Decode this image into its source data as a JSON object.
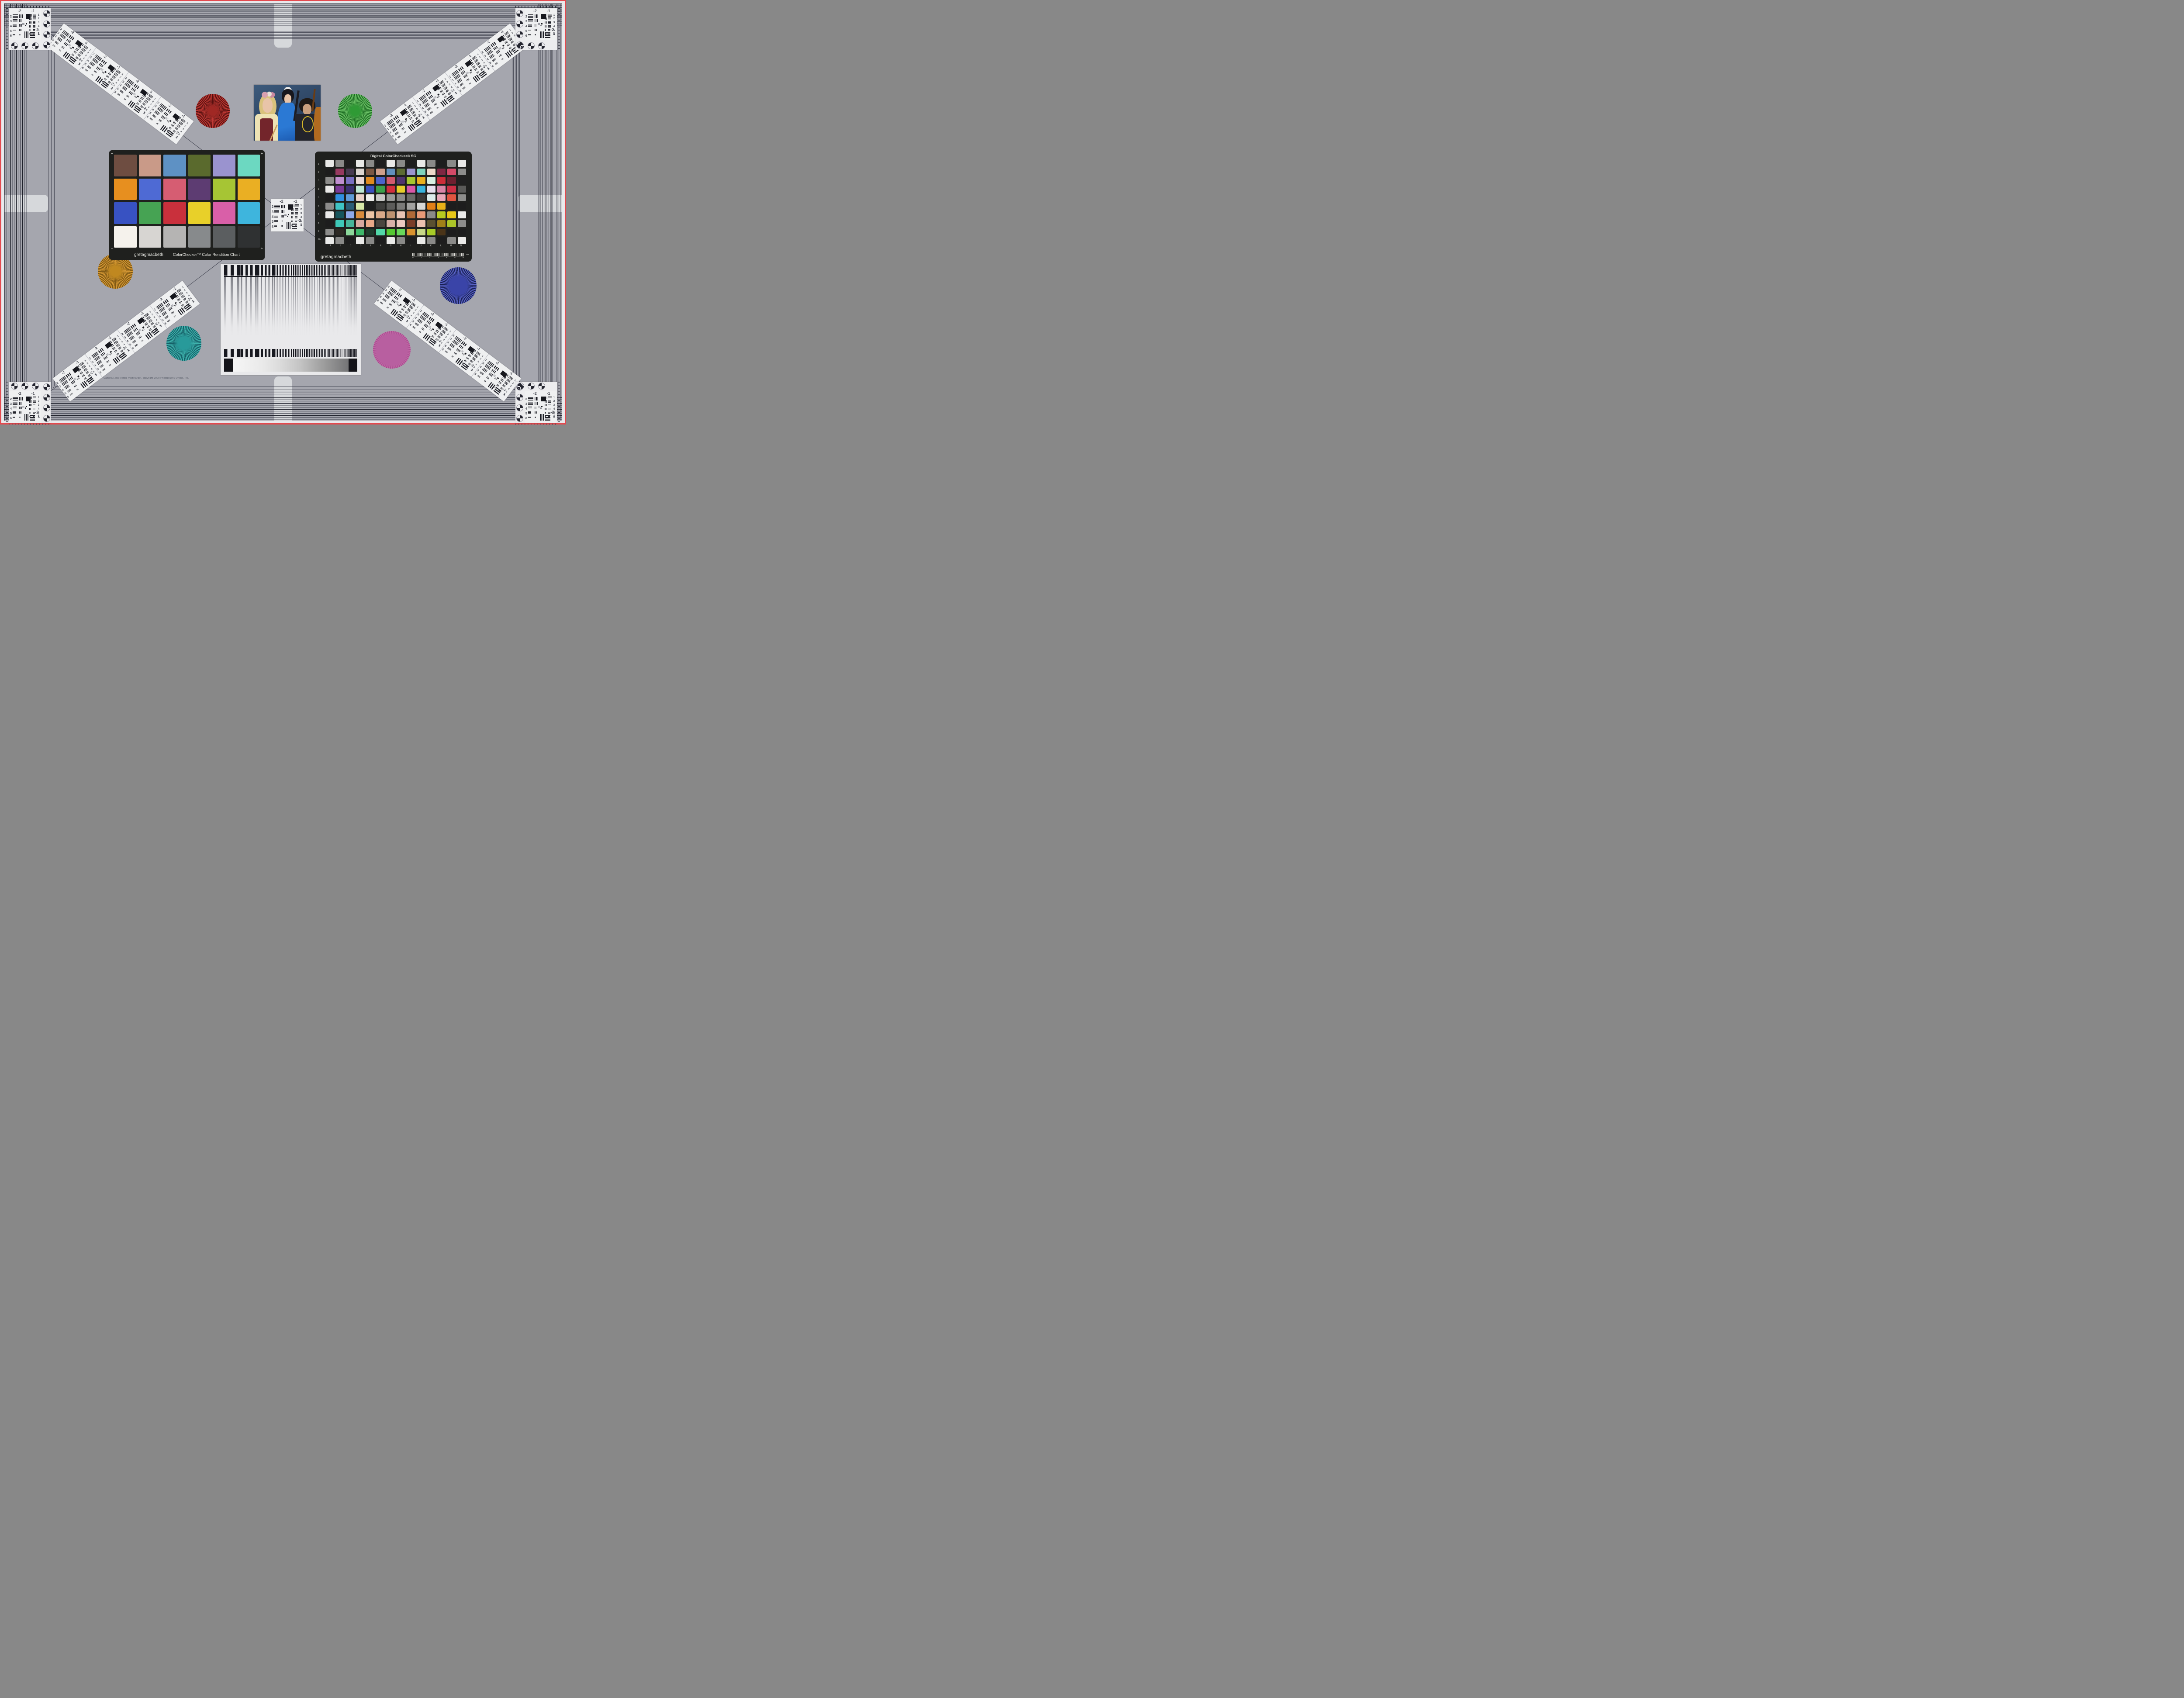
{
  "background": {
    "field_gray": "#a5a6ae",
    "edge_red": "#e4494e",
    "edge_white": "#e9e9ec",
    "line_dark": "#23242e"
  },
  "usaf_target": {
    "top_labels": [
      "-2",
      "-1"
    ],
    "left_numbers": [
      "2",
      "3",
      "4",
      "5",
      "6"
    ],
    "right_numbers": [
      "1",
      "2",
      "3",
      "4",
      "5",
      "6"
    ],
    "bottom_labels": [
      "-2",
      "1"
    ]
  },
  "colorchecker": {
    "brand": "gretagmacbeth",
    "title": "ColorChecker™ Color Rendition Chart",
    "patches": [
      "#6e4d41",
      "#c99a88",
      "#5e91c4",
      "#5a6a2d",
      "#9a93cf",
      "#6cd8c1",
      "#e78f1f",
      "#4e6ad4",
      "#d65d72",
      "#5d3c72",
      "#a6c534",
      "#eaaf23",
      "#3852c2",
      "#46a353",
      "#c9303c",
      "#e8d029",
      "#d95fa8",
      "#3eb5dd",
      "#f5f2ec",
      "#d7d5d2",
      "#b5b4b3",
      "#878a8c",
      "#5b5e60",
      "#2f3132"
    ]
  },
  "colorchecker_sg": {
    "title": "Digital ColorChecker® SG",
    "brand": "gretagmacbeth",
    "row_labels": [
      "1",
      "2",
      "3",
      "4",
      "5",
      "6",
      "7",
      "8",
      "9",
      "10"
    ],
    "column_labels": [
      "A",
      "B",
      "C",
      "D",
      "E",
      "F",
      "G",
      "H",
      "I",
      "J",
      "K",
      "L",
      "M",
      "N"
    ],
    "ruler_numbers": [
      "0",
      "1",
      "2",
      "3",
      "4",
      "5",
      "6"
    ],
    "ruler_unit": "mm",
    "patches": [
      [
        "#e9e9e7",
        "#8a8a88",
        "#1d1d1d",
        "#e9e9e7",
        "#8a8a88",
        "#1d1d1d",
        "#e9e9e7",
        "#8a8a88",
        "#1d1d1d",
        "#e9e9e7",
        "#8a8a88",
        "#1d1d1d",
        "#8a8a88",
        "#e9e9e7"
      ],
      [
        "#1d1d1d",
        "#973a60",
        "#473a50",
        "#dcd5d0",
        "#7a5743",
        "#cfa08c",
        "#6290bd",
        "#5d6b33",
        "#9a94ce",
        "#7fd3bd",
        "#ecd9c9",
        "#7e2742",
        "#d44a68",
        "#8d8d8b"
      ],
      [
        "#8c8c8a",
        "#c08fd0",
        "#7a6fc2",
        "#e9d7d5",
        "#e08a1f",
        "#4b64cc",
        "#d25a6e",
        "#50356e",
        "#a6c72f",
        "#e8b01f",
        "#d8f0e2",
        "#cc2d39",
        "#6e2030",
        "#202020"
      ],
      [
        "#e9e9e7",
        "#7a3a96",
        "#3a3172",
        "#bfe8d4",
        "#3a50c0",
        "#3ba04a",
        "#d22e3c",
        "#e6cd2a",
        "#d957a8",
        "#38b4dc",
        "#e7e0ee",
        "#d885a6",
        "#cc2f45",
        "#5a5a58"
      ],
      [
        "#1d1d1d",
        "#2f8fe0",
        "#5f9ad8",
        "#ead0c8",
        "#eeeeec",
        "#c7c7c5",
        "#9a9a98",
        "#8a8a88",
        "#6a6a68",
        "#3a3a38",
        "#dcecea",
        "#e8a8b8",
        "#e05540",
        "#8d8d8b"
      ],
      [
        "#8c8c8a",
        "#3fc4c4",
        "#2b5d76",
        "#d8e8a8",
        "#1e1e1e",
        "#3e3e3c",
        "#5c5c5a",
        "#7a7a78",
        "#a2a2a0",
        "#d8d8d6",
        "#e08018",
        "#e8b018",
        "#1d1d1d",
        "#1d1d1d"
      ],
      [
        "#eaeae8",
        "#17555c",
        "#8fa8e8",
        "#d88b3c",
        "#ecc4a4",
        "#d9a988",
        "#bd9270",
        "#e8c4b4",
        "#b06a38",
        "#e89a78",
        "#8a8a88",
        "#b8cc20",
        "#e8c818",
        "#eaeae8"
      ],
      [
        "#1d1d1d",
        "#3ec8b8",
        "#46b49a",
        "#d8a8a0",
        "#eaa888",
        "#4a443e",
        "#d8b0a8",
        "#ecc8c0",
        "#7a3c28",
        "#ecc0b0",
        "#5a5030",
        "#a08018",
        "#aac428",
        "#8d8d8b"
      ],
      [
        "#8c8c8a",
        "#2e2a24",
        "#8cd89a",
        "#3eb86a",
        "#1e3c2c",
        "#52d8a8",
        "#55c832",
        "#68d85a",
        "#d8922e",
        "#c8d888",
        "#a8cc28",
        "#4a3418",
        "#1d1d1d",
        "#1d1d1d"
      ],
      [
        "#eaeae8",
        "#8a8a88",
        "#1d1d1d",
        "#eaeae8",
        "#8a8a88",
        "#1d1d1d",
        "#eaeae8",
        "#8a8a88",
        "#1d1d1d",
        "#eaeae8",
        "#8a8a88",
        "#1d1d1d",
        "#8a8a88",
        "#eaeae8"
      ]
    ]
  },
  "siemens_stars": [
    {
      "name": "red-star",
      "light": "#c23a35",
      "dark": "#56100f",
      "core": "#a02824"
    },
    {
      "name": "green-star",
      "light": "#6ec468",
      "dark": "#1c6b22",
      "core": "#2f9a35"
    },
    {
      "name": "orange-star",
      "light": "#d89a35",
      "dark": "#7a5512",
      "core": "#c08820"
    },
    {
      "name": "teal-star",
      "light": "#3fb4ae",
      "dark": "#145e66",
      "core": "#289a9a"
    },
    {
      "name": "blue-star",
      "light": "#5a64c8",
      "dark": "#181f52",
      "core": "#3a44a8"
    },
    {
      "name": "magenta-star",
      "light": "#cf6fae",
      "dark": "#9a3f80",
      "core": "#b85fa0"
    }
  ],
  "photo": {
    "palette": {
      "background": "#2f4a68",
      "skin": "#e8c4a8",
      "blonde_hair": "#d9c27c",
      "cream_blouse": "#eee3b4",
      "maroon_dress": "#73252b",
      "blue_costume": "#2b79d4",
      "black_hair": "#17171d",
      "white_headpiece": "#e8e8e8",
      "yellow_headband": "#e5c02b",
      "necklace_yellow": "#d8b92a",
      "cello": "#b06a20",
      "dark_clothes": "#23242c"
    }
  },
  "sweep_chart": {
    "ramp_left": "#f6f6f6",
    "ramp_right": "#747476",
    "bar_color": "#17181f"
  },
  "footer": {
    "copyright": "Camera/Lens testing multi-target, copyright 2009 Photography Online, Inc."
  }
}
